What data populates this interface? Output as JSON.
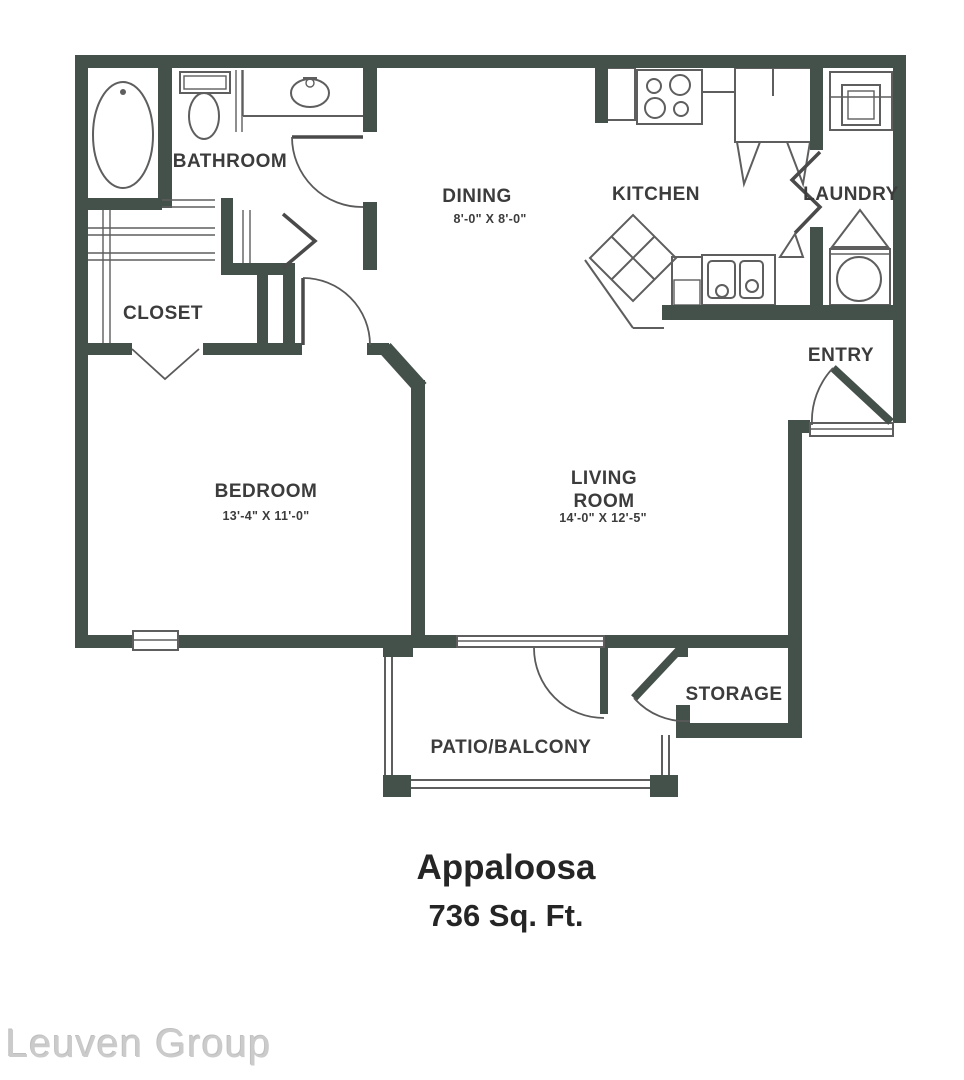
{
  "colors": {
    "background": "#ffffff",
    "wall": "#44504a",
    "line": "#5e5e5e",
    "leaf": "#4a4a4a",
    "label": "#3c3c3c",
    "title": "#252525",
    "watermark": "#cbcbcb"
  },
  "plan": {
    "rooms": {
      "bathroom": {
        "label": "BATHROOM"
      },
      "closet": {
        "label": "CLOSET"
      },
      "bedroom": {
        "label": "BEDROOM",
        "dims": "13'-4\" X 11'-0\""
      },
      "dining": {
        "label": "DINING",
        "dims": "8'-0\" X 8'-0\""
      },
      "kitchen": {
        "label": "KITCHEN"
      },
      "laundry": {
        "label": "LAUNDRY"
      },
      "entry": {
        "label": "ENTRY"
      },
      "living_room": {
        "label_line1": "LIVING",
        "label_line2": "ROOM",
        "dims": "14'-0\" X 12'-5\""
      },
      "storage": {
        "label": "STORAGE"
      },
      "patio": {
        "label": "PATIO/BALCONY"
      }
    },
    "fixtures": [
      "bathtub",
      "toilet",
      "vanity-sink",
      "range",
      "refrigerator",
      "island",
      "kitchen-sink",
      "washer",
      "dryer"
    ]
  },
  "footer": {
    "plan_name": "Appaloosa",
    "area": "736 Sq. Ft."
  },
  "watermark": "Leuven Group"
}
